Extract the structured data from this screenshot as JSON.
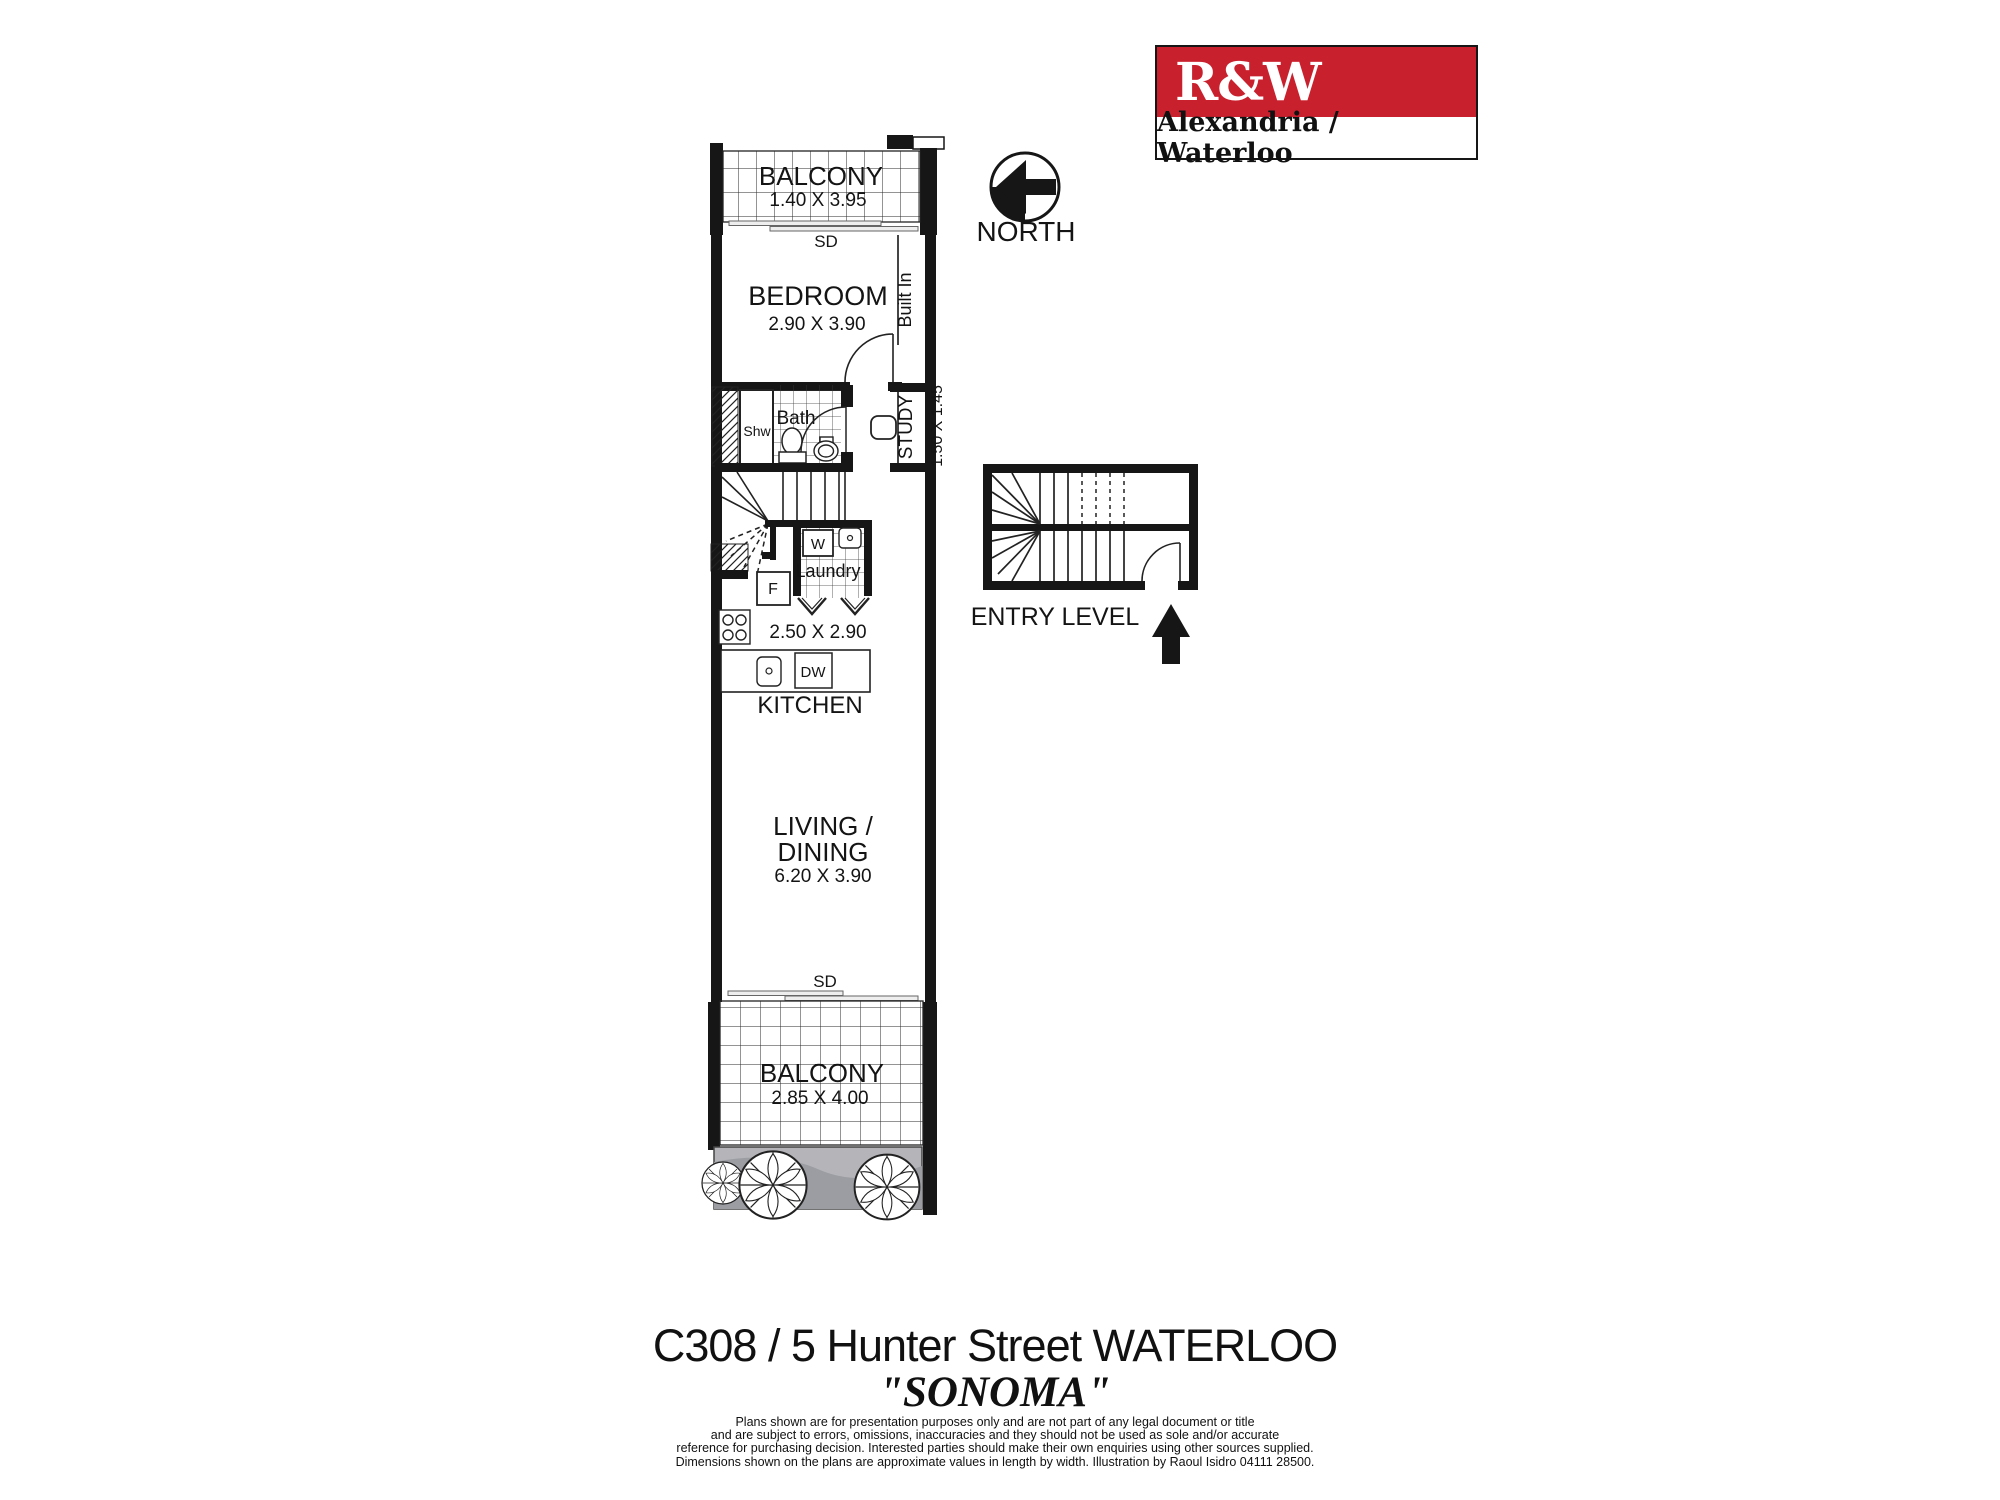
{
  "logo": {
    "brand": "R&W",
    "office": "Alexandria / Waterloo",
    "brand_bg": "#c9202e"
  },
  "compass": {
    "label": "NORTH"
  },
  "plan": {
    "balcony_top": {
      "label": "BALCONY",
      "dims": "1.40 X 3.95"
    },
    "sd_top": "SD",
    "bedroom": {
      "label": "BEDROOM",
      "dims": "2.90 X 3.90",
      "built_in": "Built In"
    },
    "bath": {
      "label": "Bath",
      "shower": "Shw"
    },
    "study": {
      "label": "STUDY",
      "dims": "1.50 X 1.45"
    },
    "laundry": {
      "label": "Laundry",
      "washer": "W",
      "fridge": "F"
    },
    "kitchen": {
      "label": "KITCHEN",
      "dims": "2.50 X 2.90",
      "dishwasher": "DW"
    },
    "living": {
      "label_line1": "LIVING /",
      "label_line2": "DINING",
      "dims": "6.20 X 3.90"
    },
    "sd_bottom": "SD",
    "balcony_bottom": {
      "label": "BALCONY",
      "dims": "2.85 X 4.00"
    },
    "entry": {
      "label": "ENTRY LEVEL"
    }
  },
  "footer": {
    "address": "C308 / 5  Hunter Street  WATERLOO",
    "building_name": "\"SONOMA\"",
    "disclaimer": [
      "Plans shown are for presentation purposes only and are not part of any legal document or title",
      "and are subject to errors, omissions, inaccuracies and they should not be used as sole and/or accurate",
      "reference for purchasing decision. Interested parties should make their own enquiries using other sources supplied.",
      "Dimensions shown on the plans are approximate values in length by width. Illustration by Raoul Isidro  04111 28500."
    ]
  }
}
